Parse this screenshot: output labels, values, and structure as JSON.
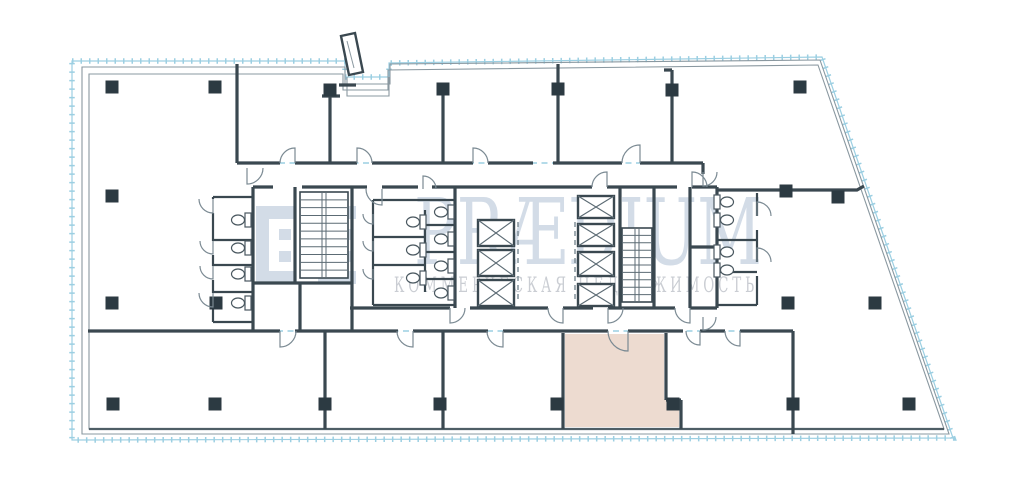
{
  "page": {
    "background": "#ffffff",
    "description": "Commercial office floor plan with central service core, lease boundary and one highlighted unit"
  },
  "watermark": {
    "brand": "PRÆDIUM",
    "tagline": "КОММЕРЧЕСКАЯ НЕДВИЖИМОСТЬ"
  },
  "colors": {
    "wall": "#3a4850",
    "column": "#2c3a42",
    "outline": "#8a98a0",
    "outline_dark": "#4e5e66",
    "boundary": "#9ccfe2",
    "door": "#7b8a93",
    "fixture": "#4a5860",
    "stair": "#5c6b74",
    "highlight": "#eddbd0",
    "wm_brand": "#b6c6d8",
    "wm_tagline": "#a7adb6"
  },
  "plan": {
    "columns": [
      [
        112,
        87
      ],
      [
        215,
        87
      ],
      [
        330,
        90
      ],
      [
        443,
        89
      ],
      [
        558,
        89
      ],
      [
        672,
        90
      ],
      [
        800,
        87
      ],
      [
        112,
        196
      ],
      [
        112,
        303
      ],
      [
        216,
        303
      ],
      [
        786,
        191
      ],
      [
        838,
        197
      ],
      [
        788,
        303
      ],
      [
        875,
        303
      ],
      [
        113,
        404
      ],
      [
        215,
        404
      ],
      [
        325,
        404
      ],
      [
        440,
        404
      ],
      [
        557,
        404
      ],
      [
        673,
        404
      ],
      [
        793,
        404
      ],
      [
        909,
        404
      ]
    ],
    "elevators": [
      [
        478,
        220,
        36,
        26
      ],
      [
        478,
        250,
        36,
        26
      ],
      [
        478,
        280,
        36,
        26
      ],
      [
        578,
        196,
        36,
        22
      ],
      [
        578,
        224,
        36,
        22
      ],
      [
        578,
        252,
        36,
        24
      ],
      [
        578,
        284,
        36,
        22
      ]
    ],
    "stairs": [
      {
        "x": 300,
        "y": 192,
        "w": 48,
        "h": 86,
        "steps": 11
      },
      {
        "x": 622,
        "y": 228,
        "w": 30,
        "h": 74,
        "steps": 10
      }
    ],
    "toilets": [
      {
        "x": 240,
        "y": 220,
        "r": 0
      },
      {
        "x": 240,
        "y": 248,
        "r": 0
      },
      {
        "x": 240,
        "y": 274,
        "r": 0
      },
      {
        "x": 240,
        "y": 303,
        "r": 0
      },
      {
        "x": 415,
        "y": 222,
        "r": 0
      },
      {
        "x": 415,
        "y": 250,
        "r": 0
      },
      {
        "x": 415,
        "y": 278,
        "r": 0
      },
      {
        "x": 443,
        "y": 212,
        "r": 0
      },
      {
        "x": 443,
        "y": 239,
        "r": 0
      },
      {
        "x": 443,
        "y": 266,
        "r": 0
      },
      {
        "x": 443,
        "y": 293,
        "r": 0
      },
      {
        "x": 725,
        "y": 202,
        "r": 180
      },
      {
        "x": 725,
        "y": 220,
        "r": 180
      },
      {
        "x": 725,
        "y": 252,
        "r": 180
      },
      {
        "x": 725,
        "y": 270,
        "r": 180
      }
    ],
    "doors": [
      {
        "p": [
          295,
          163
        ],
        "a1": 90,
        "a2": 180,
        "r": 15
      },
      {
        "p": [
          357,
          163
        ],
        "a1": 90,
        "a2": 0,
        "r": 15
      },
      {
        "p": [
          473,
          163
        ],
        "a1": 90,
        "a2": 0,
        "r": 15
      },
      {
        "p": [
          640,
          163
        ],
        "a1": 90,
        "a2": 180,
        "r": 18
      },
      {
        "p": [
          247,
          168
        ],
        "a1": 270,
        "a2": 0,
        "r": 16
      },
      {
        "p": [
          382,
          189
        ],
        "a1": 270,
        "a2": 180,
        "r": 16
      },
      {
        "p": [
          423,
          189
        ],
        "a1": 90,
        "a2": 0,
        "r": 13
      },
      {
        "p": [
          607,
          187
        ],
        "a1": 90,
        "a2": 180,
        "r": 15
      },
      {
        "p": [
          692,
          187
        ],
        "a1": 90,
        "a2": 0,
        "r": 15
      },
      {
        "p": [
          450,
          308
        ],
        "a1": 270,
        "a2": 0,
        "r": 15
      },
      {
        "p": [
          563,
          308
        ],
        "a1": 270,
        "a2": 180,
        "r": 15
      },
      {
        "p": [
          608,
          308
        ],
        "a1": 270,
        "a2": 0,
        "r": 15
      },
      {
        "p": [
          690,
          308
        ],
        "a1": 270,
        "a2": 180,
        "r": 15
      },
      {
        "p": [
          703,
          172
        ],
        "a1": 270,
        "a2": 0,
        "r": 14
      },
      {
        "p": [
          703,
          317
        ],
        "a1": 270,
        "a2": 0,
        "r": 13
      },
      {
        "p": [
          280,
          331
        ],
        "a1": 270,
        "a2": 0,
        "r": 16
      },
      {
        "p": [
          413,
          331
        ],
        "a1": 270,
        "a2": 180,
        "r": 16
      },
      {
        "p": [
          503,
          331
        ],
        "a1": 270,
        "a2": 180,
        "r": 16
      },
      {
        "p": [
          628,
          331
        ],
        "a1": 270,
        "a2": 180,
        "r": 20
      },
      {
        "p": [
          700,
          331
        ],
        "a1": 270,
        "a2": 180,
        "r": 14
      },
      {
        "p": [
          740,
          331
        ],
        "a1": 270,
        "a2": 180,
        "r": 15
      },
      {
        "p": [
          213,
          199
        ],
        "a1": 270,
        "a2": 180,
        "r": 14
      },
      {
        "p": [
          213,
          241
        ],
        "a1": 270,
        "a2": 180,
        "r": 13
      },
      {
        "p": [
          213,
          266
        ],
        "a1": 270,
        "a2": 180,
        "r": 13
      },
      {
        "p": [
          213,
          293
        ],
        "a1": 270,
        "a2": 180,
        "r": 14
      },
      {
        "p": [
          757,
          216
        ],
        "a1": 90,
        "a2": 0,
        "r": 14
      },
      {
        "p": [
          757,
          262
        ],
        "a1": 90,
        "a2": 0,
        "r": 14
      },
      {
        "p": [
          373,
          214
        ],
        "a1": 270,
        "a2": 180,
        "r": 10
      },
      {
        "p": [
          373,
          241
        ],
        "a1": 270,
        "a2": 180,
        "r": 10
      },
      {
        "p": [
          373,
          269
        ],
        "a1": 270,
        "a2": 180,
        "r": 10
      }
    ]
  }
}
